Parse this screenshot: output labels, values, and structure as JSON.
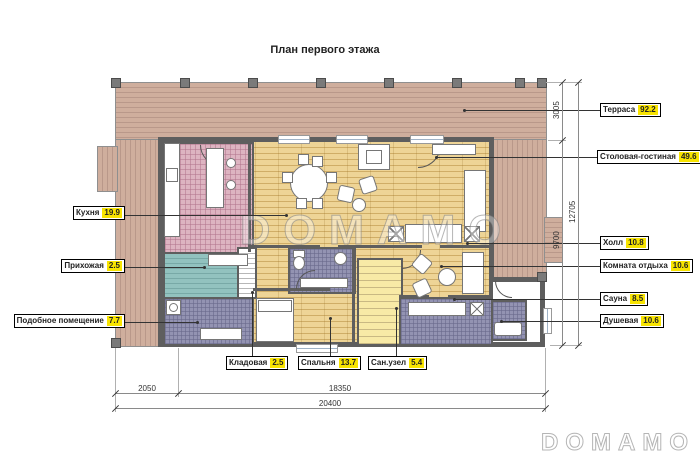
{
  "title": "План первого этажа",
  "watermark": {
    "center": "DOMAMO",
    "corner": "DOMAMO"
  },
  "labels": {
    "right": [
      {
        "name": "Терраса",
        "value": "92.2"
      },
      {
        "name": "Столовая-гостиная",
        "value": "49.6"
      },
      {
        "name": "Холл",
        "value": "10.8"
      },
      {
        "name": "Комната отдыха",
        "value": "10.6"
      },
      {
        "name": "Сауна",
        "value": "8.5"
      },
      {
        "name": "Душевая",
        "value": "10.6"
      }
    ],
    "left": [
      {
        "name": "Кухня",
        "value": "19.9"
      },
      {
        "name": "Прихожая",
        "value": "2.5"
      },
      {
        "name": "Подобное помещение",
        "value": "7.7"
      }
    ],
    "bottom": [
      {
        "name": "Кладовая",
        "value": "2.5"
      },
      {
        "name": "Спальня",
        "value": "13.7"
      },
      {
        "name": "Сан.узел",
        "value": "5.4"
      }
    ]
  },
  "dimensions": {
    "bottom": [
      "2050",
      "18350",
      "20400"
    ],
    "right": [
      "3005",
      "9700",
      "12705"
    ]
  },
  "colors": {
    "wall": "#5e5e5e",
    "label_highlight": "#f8e400",
    "terrace_wood": "#cfae9d",
    "parquet": "#eed496",
    "kitchen_tile": "#ddb4c1",
    "hall_tile": "#92c2bf",
    "wet_room_tile": "#9393b2",
    "stairs": "#f8eaa6"
  }
}
